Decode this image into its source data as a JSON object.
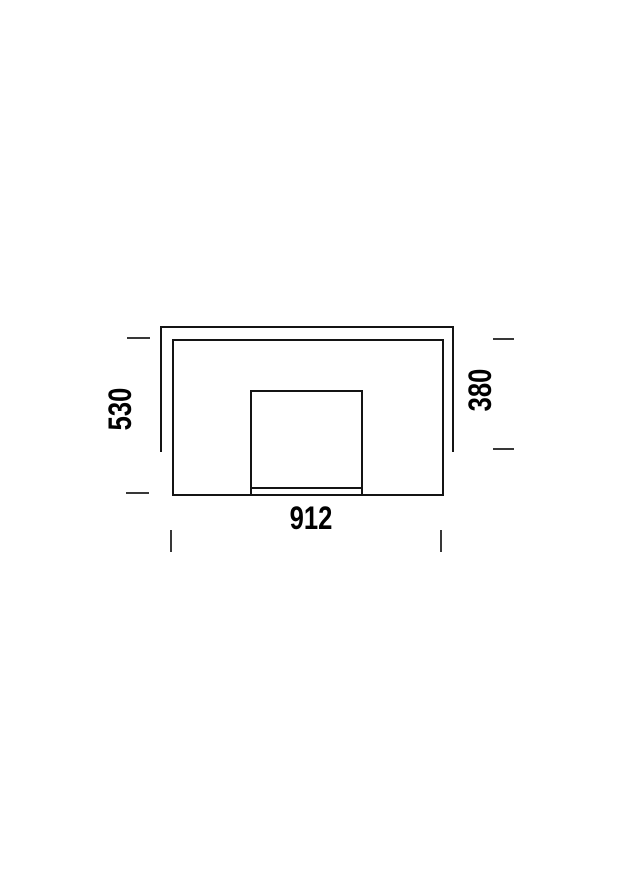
{
  "drawing": {
    "dimensions": {
      "height_left": "530",
      "height_right": "380",
      "width_bottom": "912"
    },
    "colors": {
      "line": "#141414",
      "tick": "#383838",
      "text": "#000000",
      "background": "#ffffff"
    }
  }
}
